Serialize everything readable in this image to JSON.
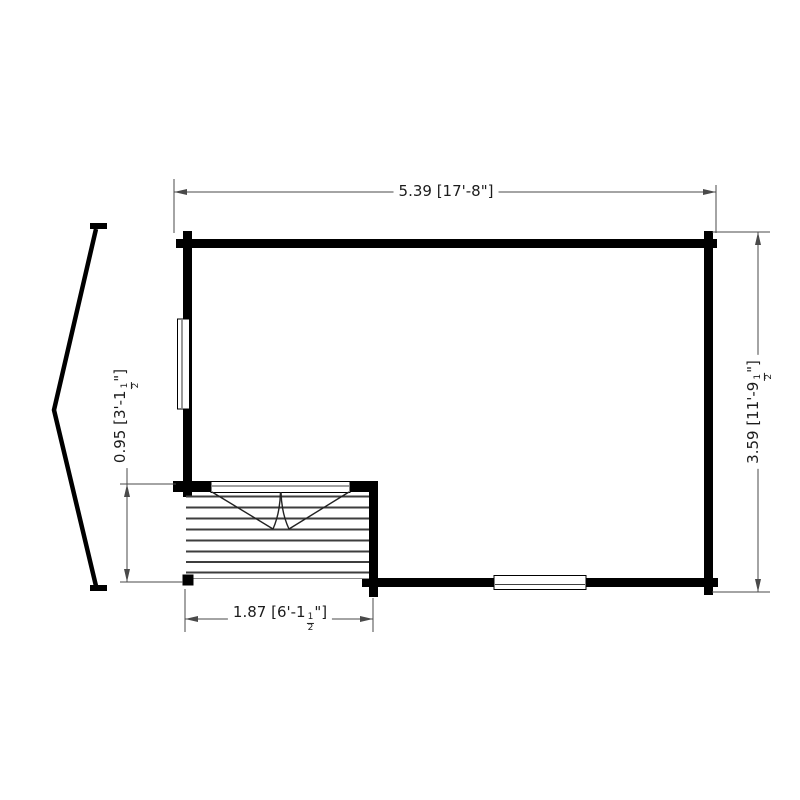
{
  "dimensions": {
    "top": {
      "text": "5.39 [17'-8\"]"
    },
    "right": {
      "pre": "3.59 [11'-9",
      "frac_num": "1",
      "frac_den": "2",
      "post": "\"]"
    },
    "left": {
      "pre": "0.95 [3'-1",
      "frac_num": "1",
      "frac_den": "2",
      "post": "\"]"
    },
    "bottom": {
      "pre": "1.87 [6'-1",
      "frac_num": "1",
      "frac_den": "2",
      "post": "\"]"
    }
  },
  "colors": {
    "wall": "#000000",
    "dim_line": "#4a4a4a",
    "deck_board": "#3e3e3e",
    "door_swing": "#222222",
    "window_frame": "#000000",
    "text": "#1c1c1c",
    "background": "#ffffff"
  }
}
